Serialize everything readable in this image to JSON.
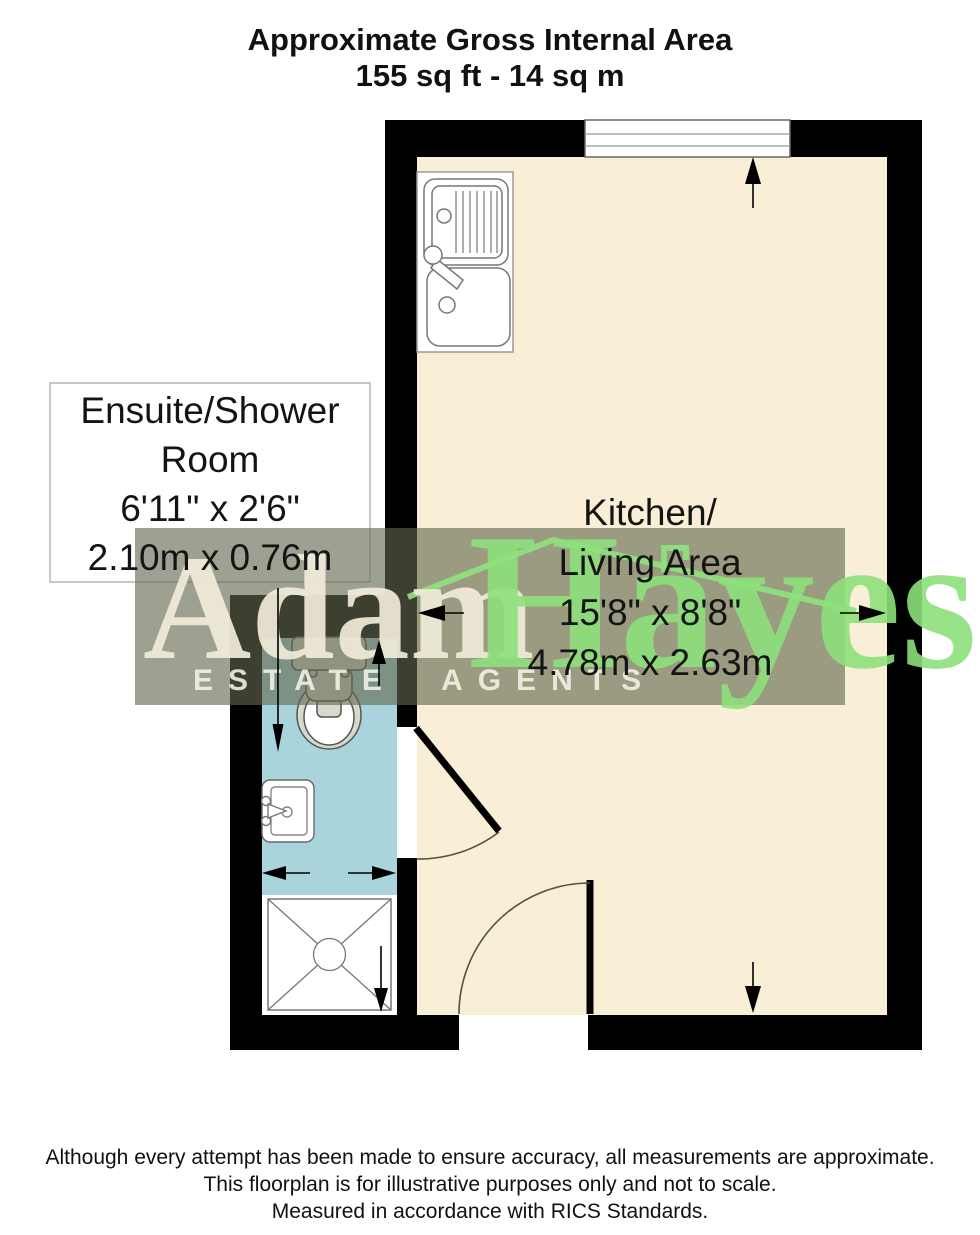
{
  "title": {
    "line1": "Approximate Gross Internal Area",
    "line2": "155 sq ft - 14 sq m"
  },
  "rooms": {
    "ensuite": {
      "name_line1": "Ensuite/Shower",
      "name_line2": "Room",
      "dims_imperial": "6'11\" x 2'6\"",
      "dims_metric": "2.10m x 0.76m"
    },
    "kitchen": {
      "name_line1": "Kitchen/",
      "name_line2": "Living Area",
      "dims_imperial": "15'8\" x 8'8\"",
      "dims_metric": "4.78m x 2.63m"
    }
  },
  "watermark": {
    "brand_first": "Adam",
    "brand_last": "Hayes",
    "tagline": "ESTATE AGENTS"
  },
  "disclaimer": {
    "line1": "Although every attempt has been made to ensure accuracy, all measurements are approximate.",
    "line2": "This floorplan is for illustrative purposes only and not to scale.",
    "line3": "Measured in accordance with RICS Standards."
  },
  "colors": {
    "wall": "#000000",
    "kitchen_floor": "#f8efd6",
    "ensuite_floor": "#a9d4dc",
    "brand_green": "#8de07b",
    "brand_cream": "#f1ebd9",
    "watermark_band": "#63674"
  }
}
